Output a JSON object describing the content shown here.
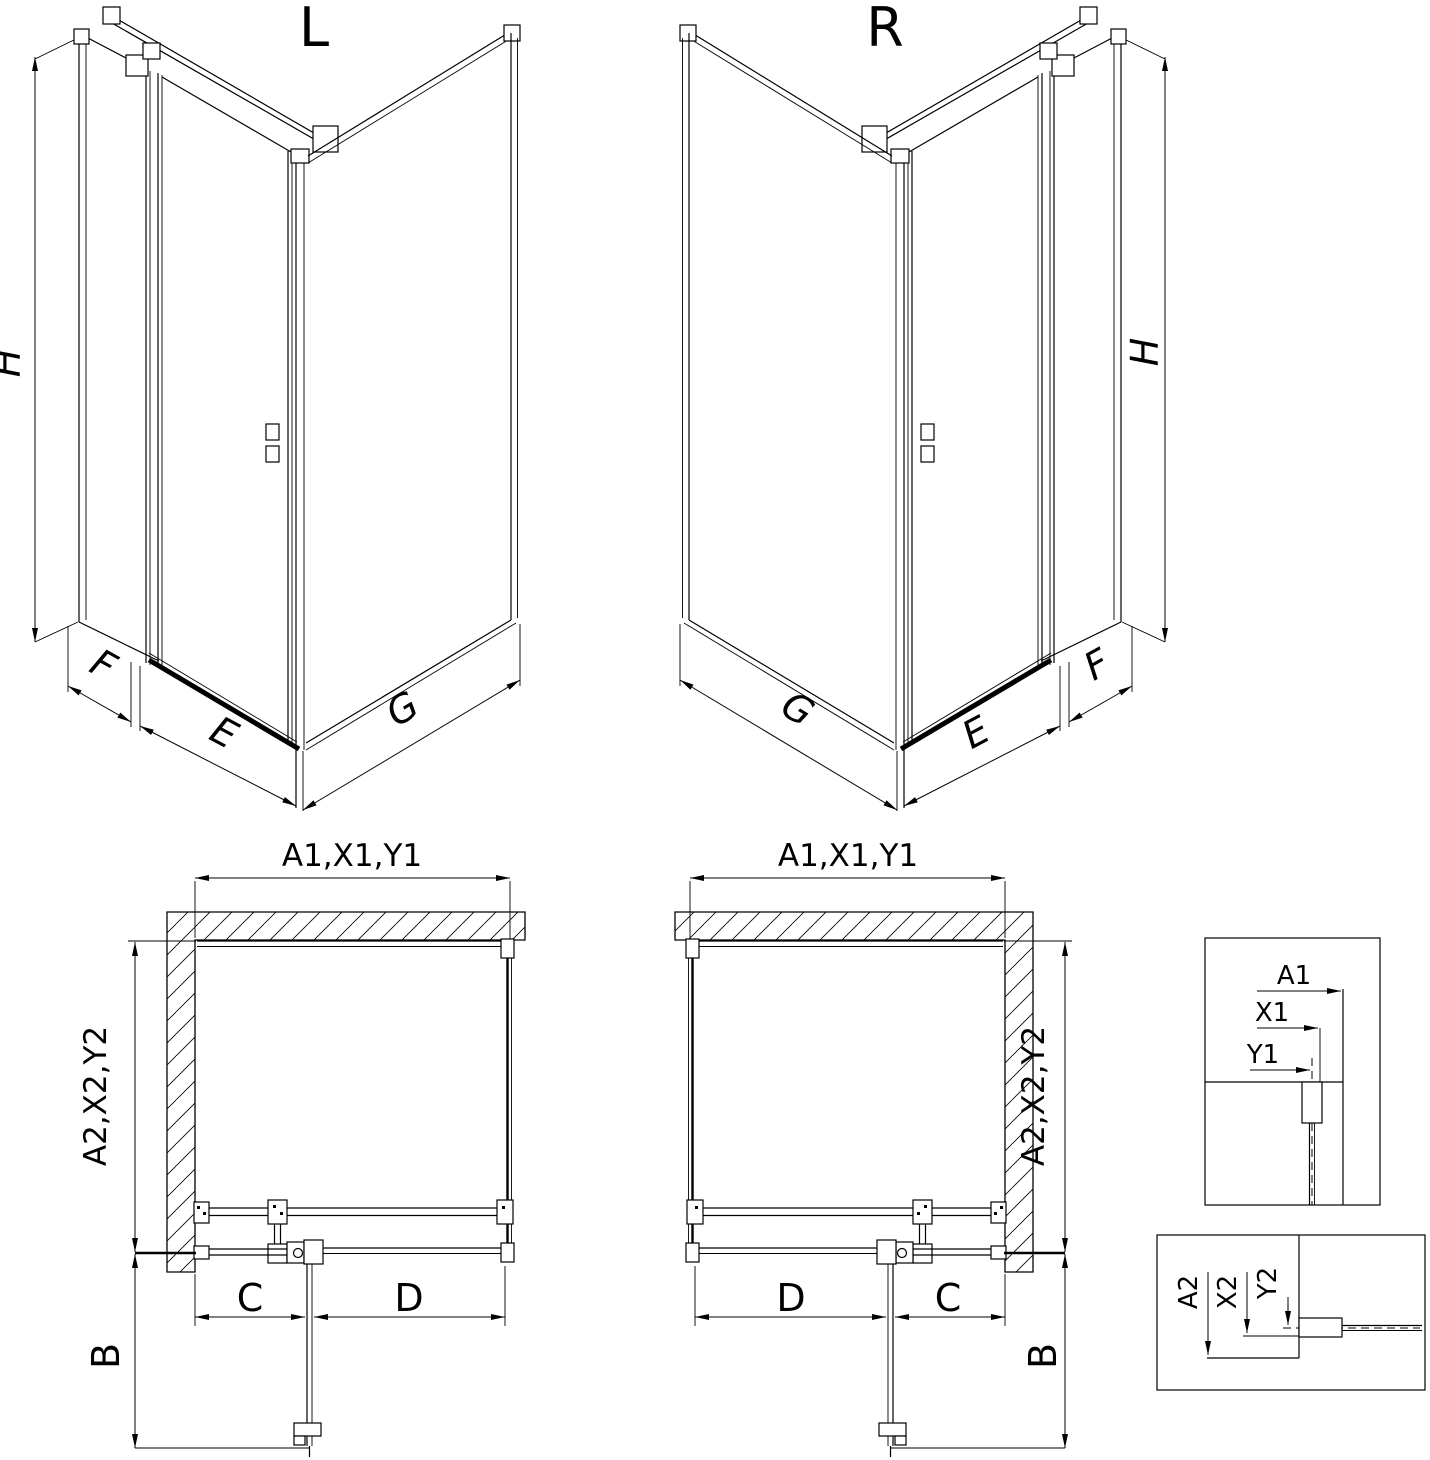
{
  "colors": {
    "line": "#000000",
    "background": "#ffffff"
  },
  "views": {
    "iso_left": {
      "title": "L",
      "labels": {
        "height": "H",
        "side": "F",
        "door": "E",
        "return": "G"
      }
    },
    "iso_right": {
      "title": "R",
      "labels": {
        "height": "H",
        "side": "F",
        "door": "E",
        "return": "G"
      }
    },
    "plan_left": {
      "labels": {
        "width": "A1,X1,Y1",
        "depth": "A2,X2,Y2",
        "swing": "B",
        "fixed": "C",
        "door": "D"
      }
    },
    "plan_right": {
      "labels": {
        "width": "A1,X1,Y1",
        "depth": "A2,X2,Y2",
        "swing": "B",
        "fixed": "C",
        "door": "D"
      }
    },
    "detail_top": {
      "labels": {
        "a": "A1",
        "x": "X1",
        "y": "Y1"
      }
    },
    "detail_bottom": {
      "labels": {
        "a": "A2",
        "x": "X2",
        "y": "Y2"
      }
    }
  }
}
